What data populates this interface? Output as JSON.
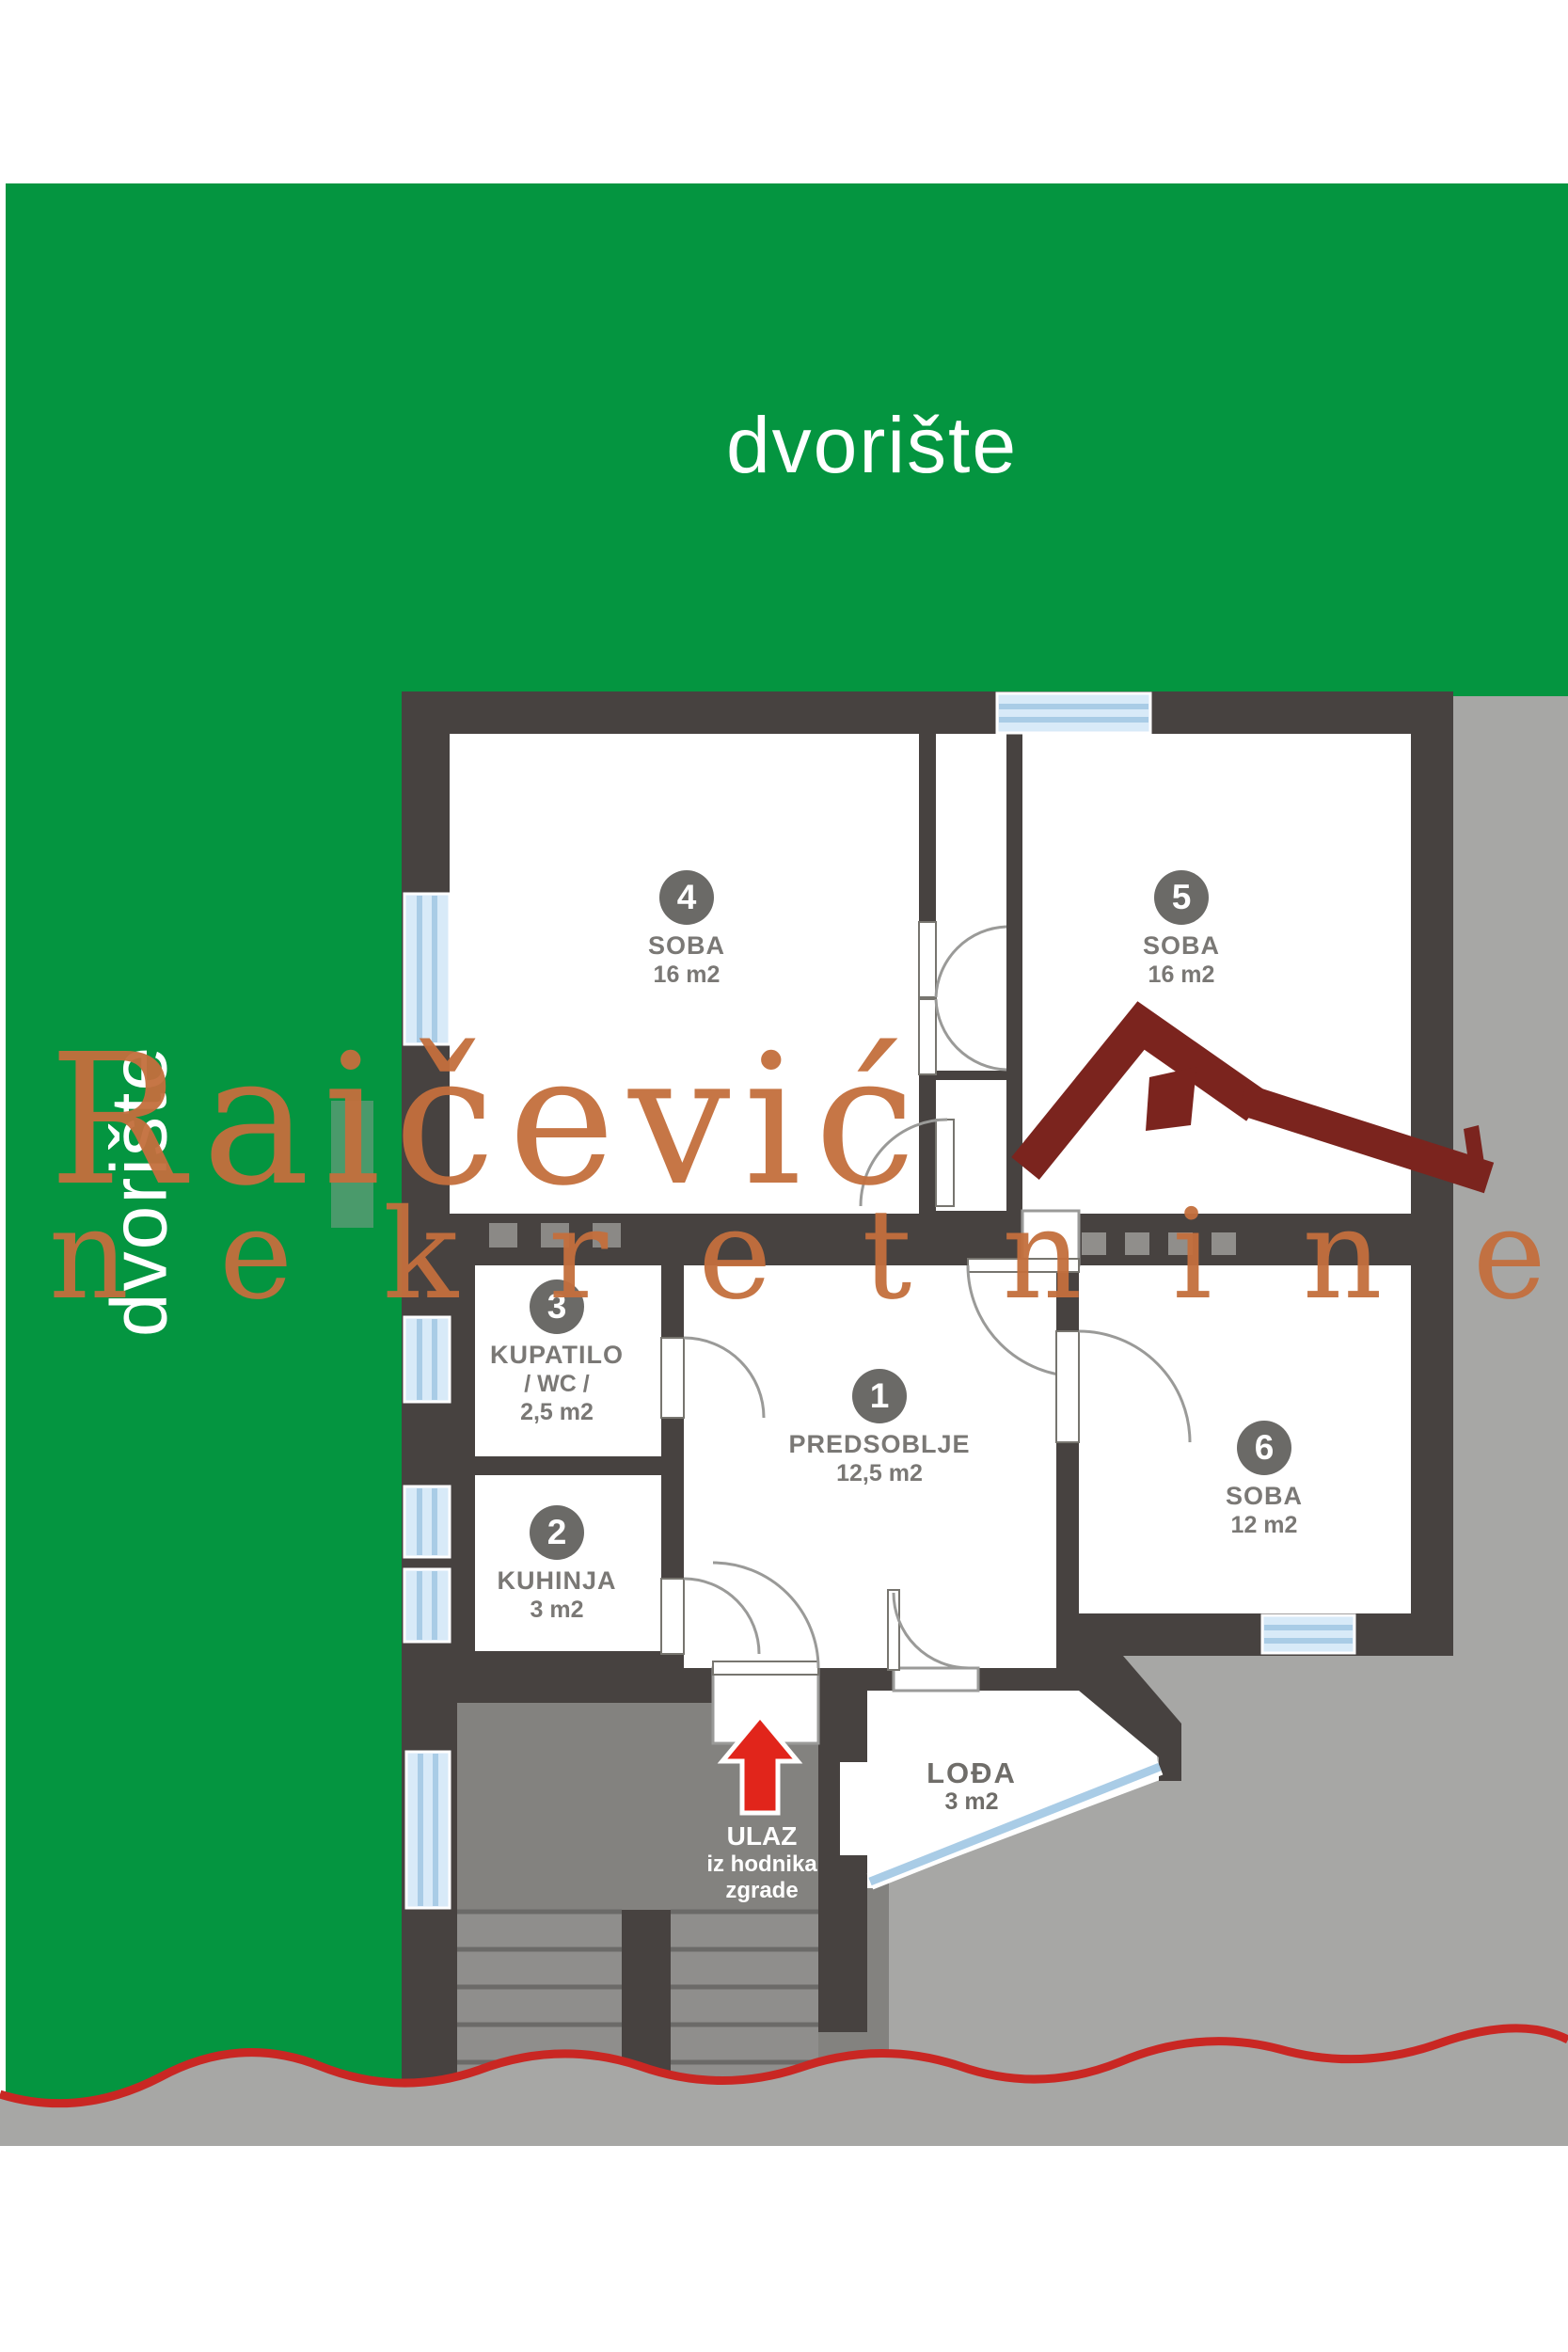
{
  "yard": {
    "top_label": "dvorište",
    "left_label": "dvorište"
  },
  "watermark": {
    "brand": "Raičević",
    "line2": "nekretnine"
  },
  "rooms": {
    "r1": {
      "number": "1",
      "name": "PREDSOBLJE",
      "area": "12,5 m2"
    },
    "r2": {
      "number": "2",
      "name": "KUHINJA",
      "area": "3 m2"
    },
    "r3": {
      "number": "3",
      "name": "KUPATILO",
      "sub": "/ WC /",
      "area": "2,5 m2"
    },
    "r4": {
      "number": "4",
      "name": "SOBA",
      "area": "16 m2"
    },
    "r5": {
      "number": "5",
      "name": "SOBA",
      "area": "16 m2"
    },
    "r6": {
      "number": "6",
      "name": "SOBA",
      "area": "12 m2"
    }
  },
  "loggia": {
    "name": "LOĐA",
    "area": "3 m2"
  },
  "entrance": {
    "title": "ULAZ",
    "line2": "iz hodnika",
    "line3": "zgrade"
  },
  "colors": {
    "yard_green": "#049540",
    "wall_dark": "#474240",
    "outside_grey": "#a7a7a5",
    "porch_grey": "#83827f",
    "stair_grey": "#8f8e8c",
    "window_blue": "#d8eaf8",
    "accent_red": "#e1251b",
    "wave_red": "#c92723",
    "watermark_orange": "#c46f3d",
    "logo_maroon": "#7b241e",
    "label_grey": "#7a7875"
  }
}
